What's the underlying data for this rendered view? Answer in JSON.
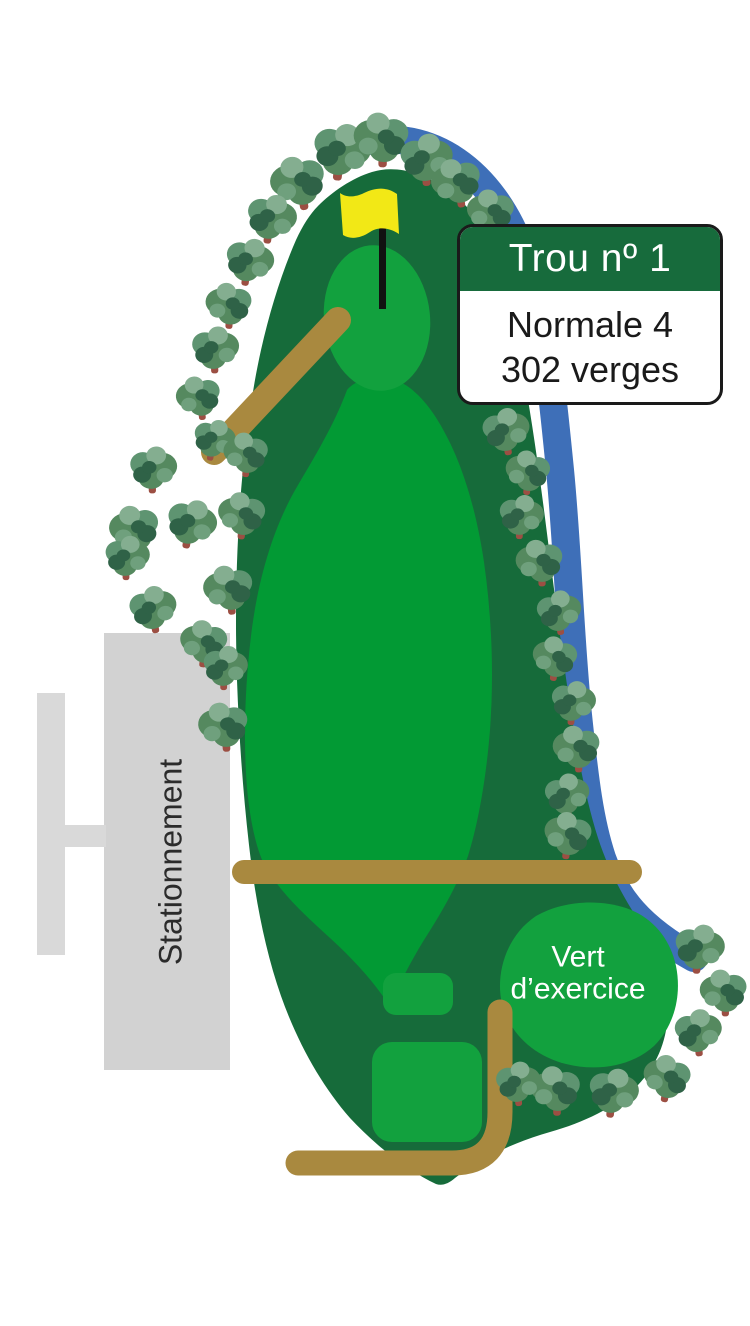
{
  "card": {
    "title": "Trou nº 1",
    "par_label": "Normale 4",
    "distance_label": "302 verges"
  },
  "labels": {
    "parking": "Stationnement",
    "practice_green_line1": "Vert",
    "practice_green_line2": "d’exercice"
  },
  "colors": {
    "rough": "#166B3A",
    "fairway": "#029A34",
    "green": "#12A13E",
    "water": "#3E6FB8",
    "cart_path": "#A9893F",
    "parking": "#D2D2D2",
    "parking_rows": "#D9D9D9",
    "card_header": "#176B3C",
    "card_border": "#1A1A1A",
    "flag": "#F2E816",
    "flagstick": "#111111",
    "tree_mid": "#55895F",
    "tree_mid2": "#5E9471",
    "tree_light": "#84AE90",
    "tree_light2": "#6FA07D",
    "tree_dark": "#2F6247",
    "tree_trunk": "#9C4F43",
    "label_dark": "#2B2B2B",
    "label_light": "#FFFFFF"
  }
}
